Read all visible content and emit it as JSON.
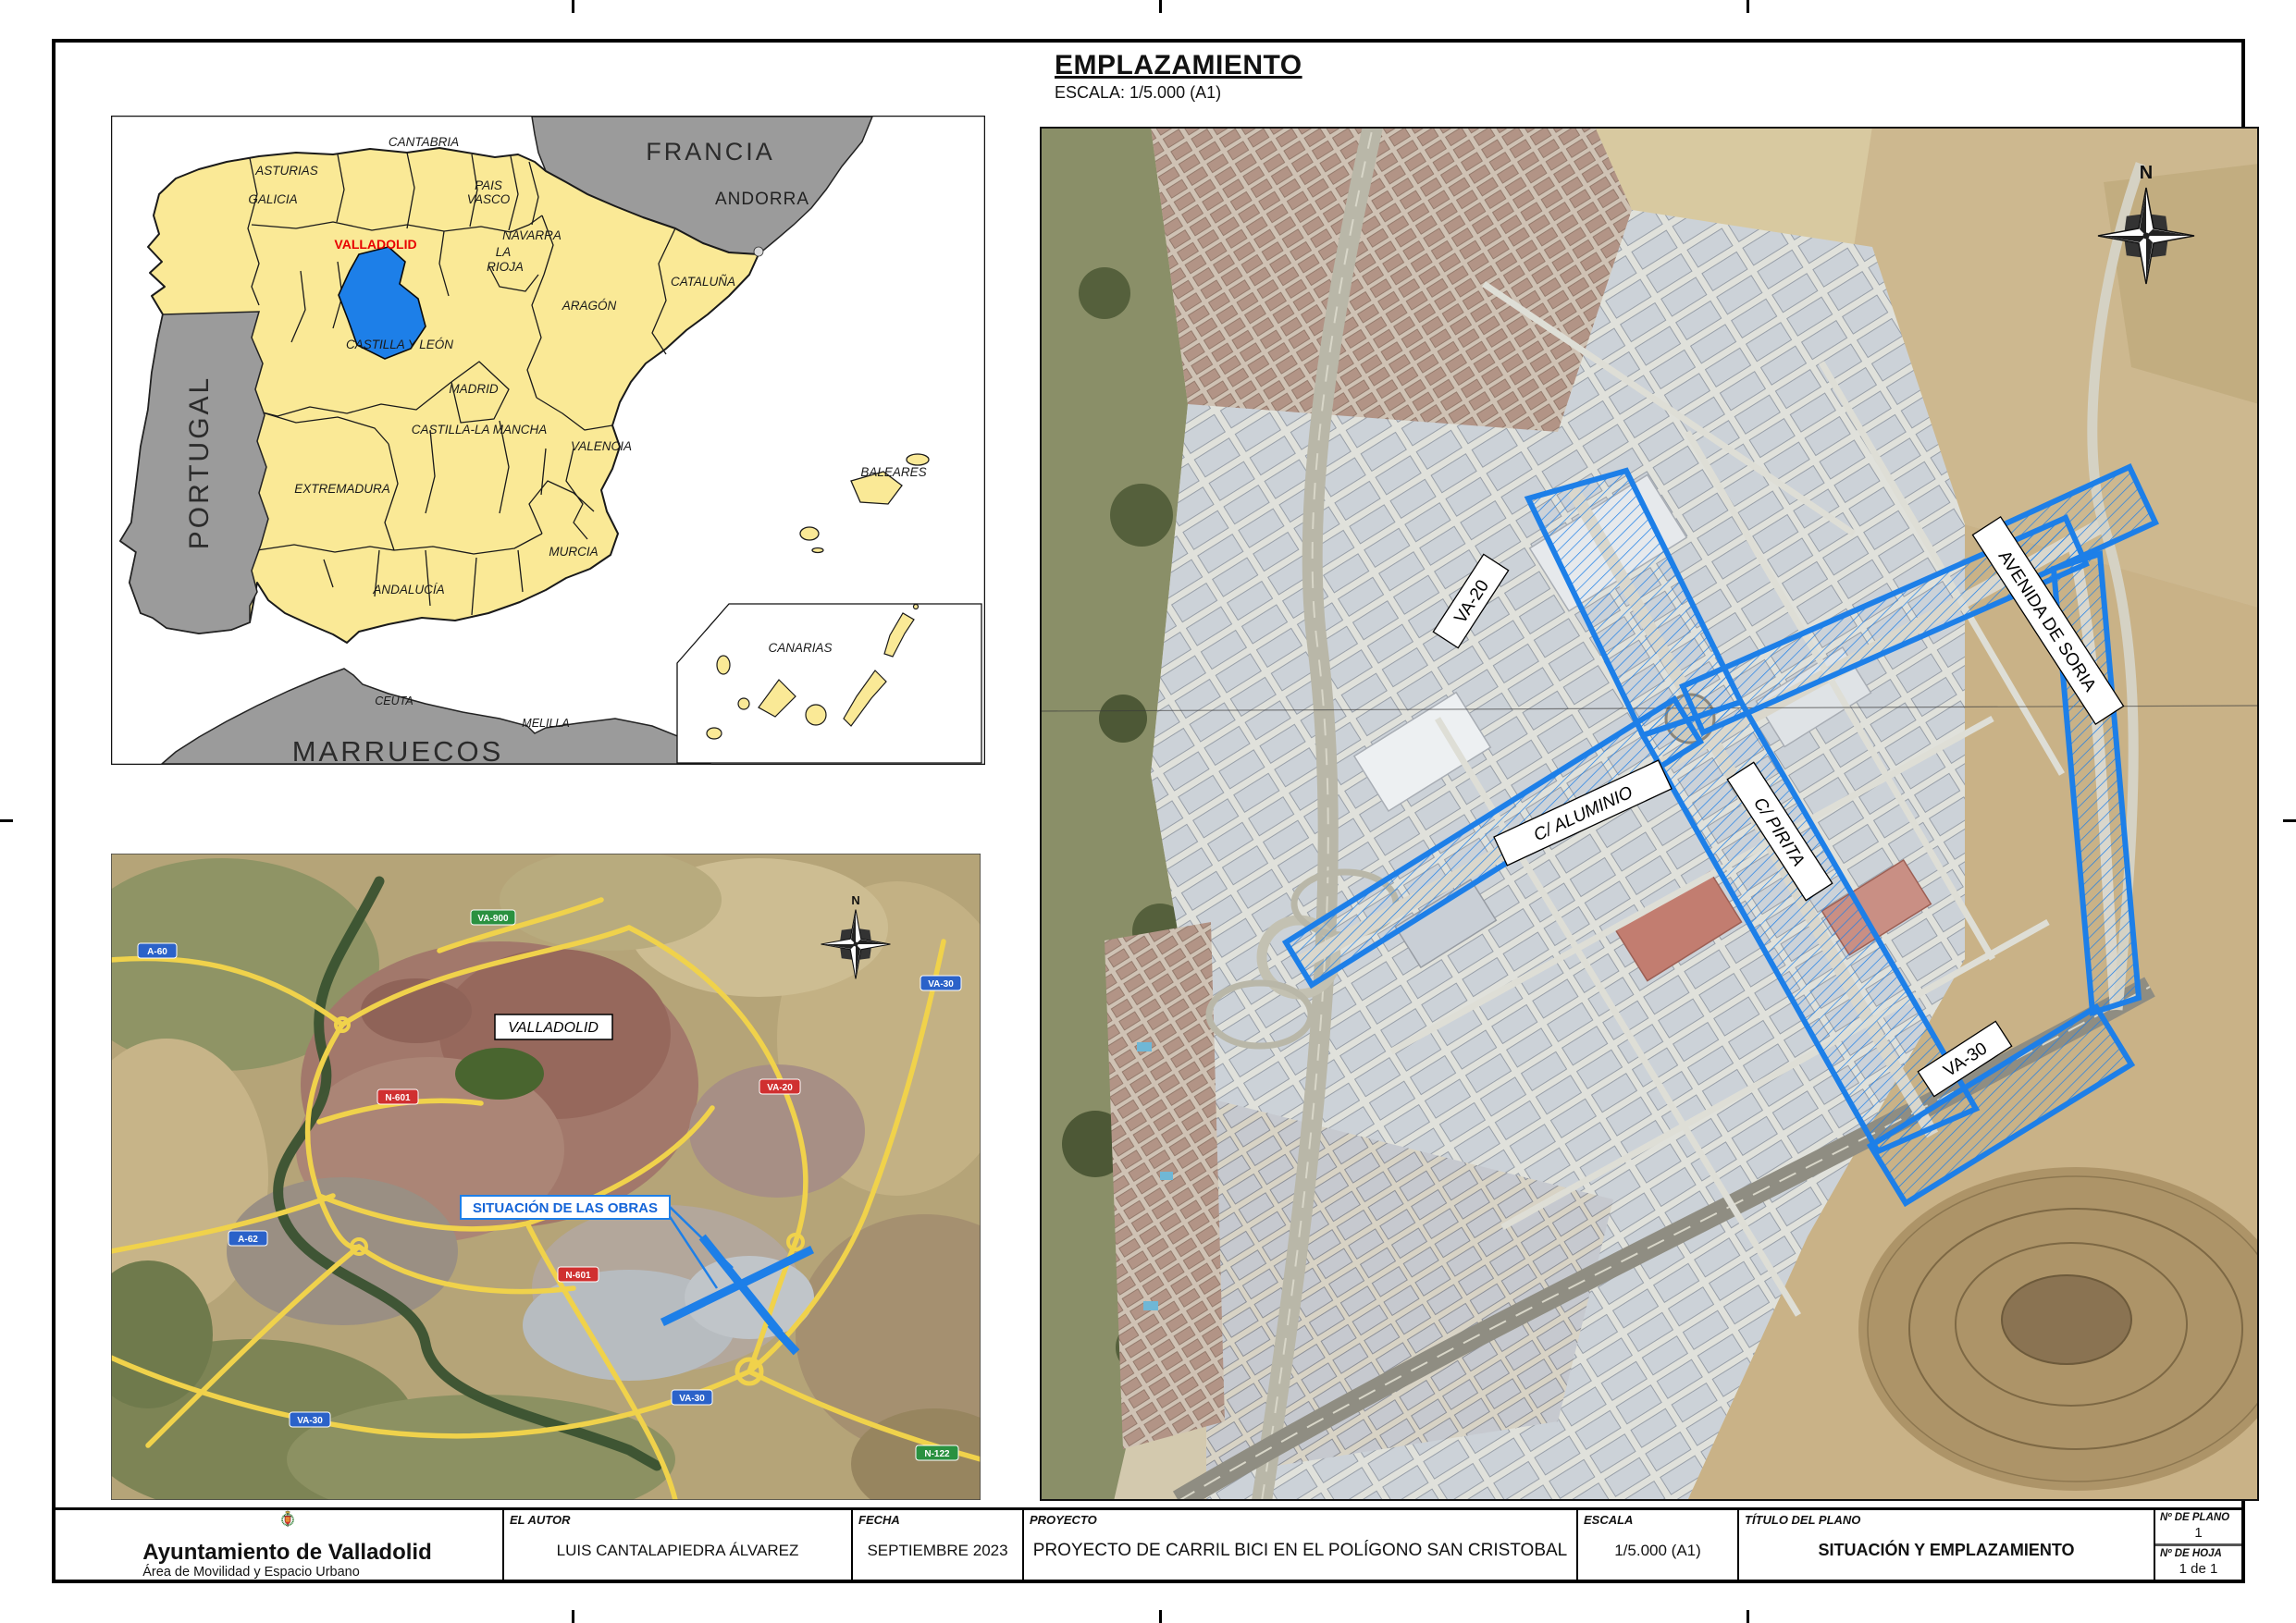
{
  "site_map": {
    "title": "EMPLAZAMIENTO",
    "scale": "ESCALA: 1/5.000 (A1)",
    "compass_n": "N",
    "route_color": "#1d7fe8",
    "streets": {
      "va20": "VA-20",
      "aluminio": "C/ ALUMINIO",
      "pirita": "C/ PIRITA",
      "soria": "AVENIDA DE SORIA",
      "va30": "VA-30"
    }
  },
  "spain_map": {
    "colors": {
      "region_fill": "#FAE996",
      "highlight_fill": "#1d7fe8",
      "neighbor_fill": "#9B9B9B",
      "sea": "#FFFFFF"
    },
    "labels": {
      "francia": "FRANCIA",
      "andorra": "ANDORRA",
      "portugal": "PORTUGAL",
      "marruecos": "MARRUECOS",
      "galicia": "GALICIA",
      "asturias": "ASTURIAS",
      "cantabria": "CANTABRIA",
      "pais": "PAIS",
      "vasco": "VASCO",
      "navarra": "NAVARRA",
      "la": "LA",
      "rioja": "RIOJA",
      "aragon": "ARAGÓN",
      "cataluna": "CATALUÑA",
      "castilla_leon": "CASTILLA Y LEÓN",
      "madrid": "MADRID",
      "castilla_mancha": "CASTILLA-LA MANCHA",
      "valencia": "VALENCIA",
      "extremadura": "EXTREMADURA",
      "murcia": "MURCIA",
      "andalucia": "ANDALUCÍA",
      "baleares": "BALEARES",
      "canarias": "CANARIAS",
      "ceuta": "CEUTA",
      "melilla": "MELILLA",
      "valladolid": "VALLADOLID"
    }
  },
  "city_map": {
    "city_label": "VALLADOLID",
    "works_label": "SITUACIÓN DE LAS OBRAS",
    "compass_n": "N",
    "roads": {
      "a60": "A-60",
      "va900": "VA-900",
      "va30_a": "VA-30",
      "va20": "VA-20",
      "n601_a": "N-601",
      "a62": "A-62",
      "n601_b": "N-601",
      "va30_b": "VA-30",
      "va30_c": "VA-30",
      "n122": "N-122"
    },
    "shield_colors": {
      "blue": "#2b62c9",
      "red": "#d03030",
      "green": "#2a9140"
    }
  },
  "title_block": {
    "org_name": "Ayuntamiento de Valladolid",
    "org_dept": "Área de Movilidad y Espacio Urbano",
    "author_label": "EL AUTOR",
    "author_value": "LUIS CANTALAPIEDRA ÁLVAREZ",
    "date_label": "FECHA",
    "date_value": "SEPTIEMBRE 2023",
    "project_label": "PROYECTO",
    "project_value": "PROYECTO DE CARRIL BICI EN EL POLÍGONO SAN CRISTOBAL",
    "scale_label": "ESCALA",
    "scale_value": "1/5.000 (A1)",
    "plan_title_label": "TÍTULO DEL PLANO",
    "plan_title_value": "SITUACIÓN Y EMPLAZAMIENTO",
    "plan_no_label": "Nº DE PLANO",
    "plan_no_value": "1",
    "sheet_no_label": "Nº DE HOJA",
    "sheet_no_value": "1 de 1"
  }
}
